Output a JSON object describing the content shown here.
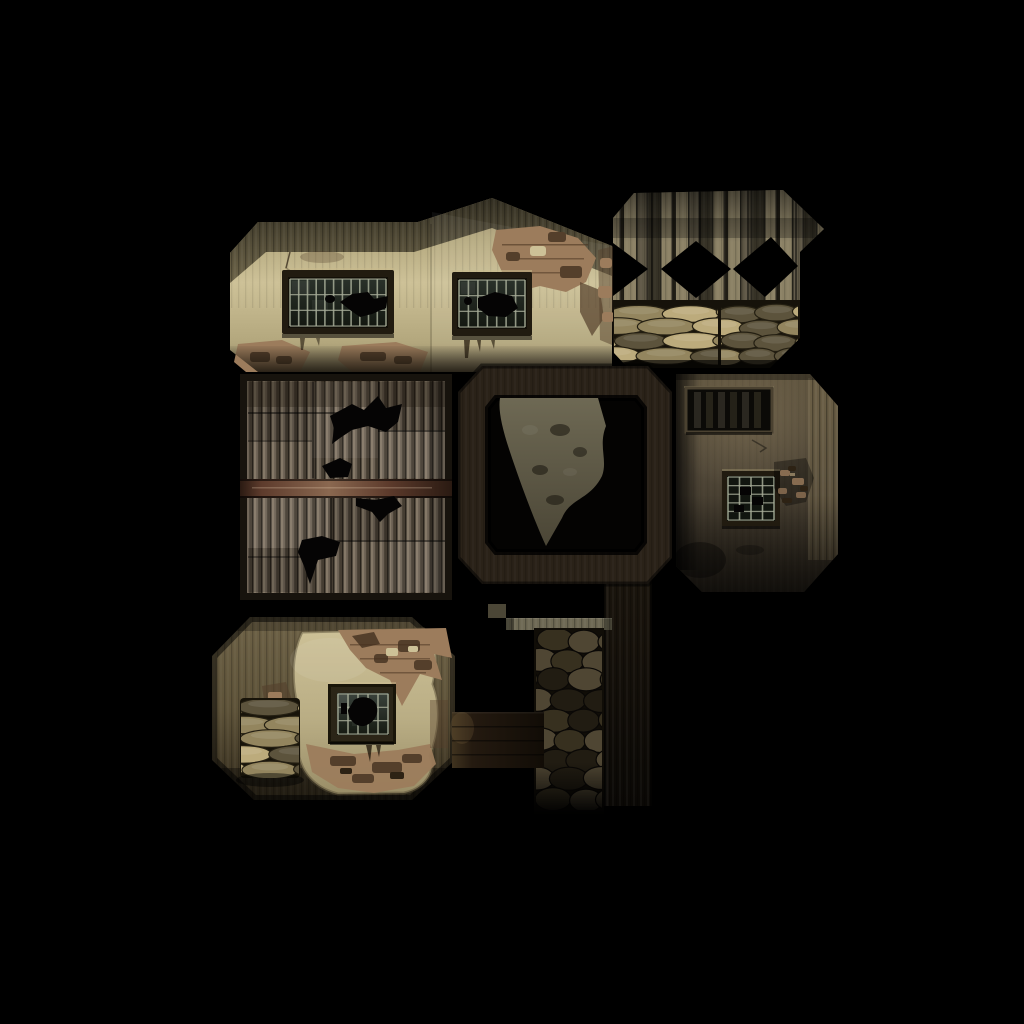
{
  "meta": {
    "content_type": "game-texture-atlas",
    "description": "UV texture atlas sheet for a war-damaged desert building 3D model on a black background",
    "canvas": {
      "width": 1024,
      "height": 1024
    }
  },
  "palette": {
    "background": "#000000",
    "stucco_light": "#cdc197",
    "stucco_mid": "#b3a77d",
    "stucco_shadow": "#8d8163",
    "roof_band": "#6f664a",
    "roof_band_dark": "#3e382a",
    "peel_brick": "#9c7c5c",
    "peel_dark": "#543f2b",
    "peel_deep": "#2d2214",
    "window_frame": "#211b10",
    "window_frame_dark": "#120f08",
    "window_bar": "#a6ab97",
    "window_glass": "#2a312a",
    "window_glass_dark": "#141811",
    "plank_light": "#8b8165",
    "plank_mid": "#605947",
    "plank_dark": "#363226",
    "plank_deep": "#201d15",
    "sandbag_light": "#bcab7c",
    "sandbag_mid": "#93855e",
    "sandbag_dark": "#5c533c",
    "corrugated_light": "#847867",
    "corrugated_mid": "#6b6053",
    "corrugated_dark": "#453d32",
    "corrugated_deep": "#27221b",
    "beam_brown": "#5d3b2c",
    "beam_light": "#8a6850",
    "beam_dark": "#2a1a12",
    "frame_brown": "#2a2218",
    "debris_olive": "#6e6954",
    "debris_olive_dark": "#4b4636",
    "wall_olive": "#4f4637",
    "wall_olive_light": "#6f634d",
    "wall_olive_dark": "#2c261d",
    "surround_olive": "#75684b",
    "stone_light": "#4f4633",
    "stone_mid": "#37301f",
    "stone_dark": "#211c12",
    "wood_dark": "#241b11"
  },
  "atlas": {
    "patches": [
      {
        "id": "gabled-wall",
        "label": "Gabled stucco wall with two barred windows and peeling plaster",
        "bbox": [
          230,
          198,
          382,
          174
        ],
        "windows": [
          {
            "type": "barred",
            "grid": "11x3",
            "bbox": [
              282,
              270,
              112,
              64
            ]
          },
          {
            "type": "barred",
            "grid": "7x3",
            "bbox": [
              452,
              272,
              80,
              64
            ]
          }
        ]
      },
      {
        "id": "barricade",
        "label": "Wood plank barricade with X cross-brace cutouts over two sandbag stacks",
        "bbox": [
          613,
          190,
          187,
          178
        ],
        "sandbag_rows": 4
      },
      {
        "id": "corrugated-wall",
        "label": "Corrugated metal panels with shell holes and horizontal timber rail",
        "bbox": [
          240,
          374,
          212,
          226
        ]
      },
      {
        "id": "timber-frame",
        "label": "Dark timber opening frame with rubble fragment and vertical post",
        "bbox": [
          458,
          366,
          214,
          218
        ]
      },
      {
        "id": "interior-wall",
        "label": "Dim interior wall with slatted vent and small barred window",
        "bbox": [
          674,
          372,
          164,
          220
        ],
        "windows": [
          {
            "type": "slatted",
            "bbox": [
              686,
              388,
              86,
              44
            ]
          },
          {
            "type": "barred",
            "grid": "4x5",
            "bbox": [
              722,
              471,
              58,
              55
            ]
          }
        ]
      },
      {
        "id": "lower-wall",
        "label": "Weathered stucco wall with barred window and sandbag stack",
        "bbox": [
          212,
          615,
          243,
          185
        ],
        "windows": [
          {
            "type": "barred",
            "grid": "5x3",
            "bbox": [
              328,
              684,
              68,
              60
            ]
          }
        ]
      },
      {
        "id": "stone-column",
        "label": "Stacked stone pillar with lintel, timber crossbar and dark post",
        "bbox": [
          452,
          580,
          200,
          238
        ]
      }
    ]
  },
  "generated": {
    "grids": [
      {
        "id": "grid-w1",
        "x": 290,
        "y": 279,
        "w": 96,
        "h": 47,
        "cols": 11,
        "rows": 3
      },
      {
        "id": "grid-w2",
        "x": 459,
        "y": 280,
        "w": 66,
        "h": 47,
        "cols": 7,
        "rows": 3
      },
      {
        "id": "grid-w3",
        "x": 728,
        "y": 477,
        "w": 46,
        "h": 43,
        "cols": 4,
        "rows": 5
      },
      {
        "id": "grid-w4",
        "x": 338,
        "y": 694,
        "w": 50,
        "h": 40,
        "cols": 5,
        "rows": 3
      }
    ],
    "stacks": [
      {
        "id": "bags-barricade-left",
        "x": 615,
        "y": 305,
        "w": 102,
        "h": 58,
        "rows": 4,
        "cols": 2,
        "seed": 11,
        "highlight": true,
        "colors": [
          "sandbag_light",
          "sandbag_mid",
          "sandbag_dark"
        ],
        "stroke": "#241f12"
      },
      {
        "id": "bags-barricade-right",
        "x": 722,
        "y": 305,
        "w": 75,
        "h": 58,
        "rows": 4,
        "cols": 2,
        "seed": 23,
        "highlight": true,
        "colors": [
          "sandbag_mid",
          "sandbag_light",
          "sandbag_dark"
        ],
        "stroke": "#241f12"
      },
      {
        "id": "bags-lower-wall",
        "x": 243,
        "y": 700,
        "w": 54,
        "h": 76,
        "rows": 5,
        "cols": 1,
        "seed": 37,
        "highlight": true,
        "colors": [
          "sandbag_light",
          "sandbag_mid",
          "sandbag_dark"
        ],
        "stroke": "#241f12"
      },
      {
        "id": "stones-column",
        "x": 538,
        "y": 630,
        "w": 62,
        "h": 178,
        "rows": 9,
        "cols": 2,
        "seed": 51,
        "highlight": false,
        "colors": [
          "stone_light",
          "stone_mid",
          "stone_dark"
        ],
        "stroke": "#0a0806"
      }
    ]
  }
}
